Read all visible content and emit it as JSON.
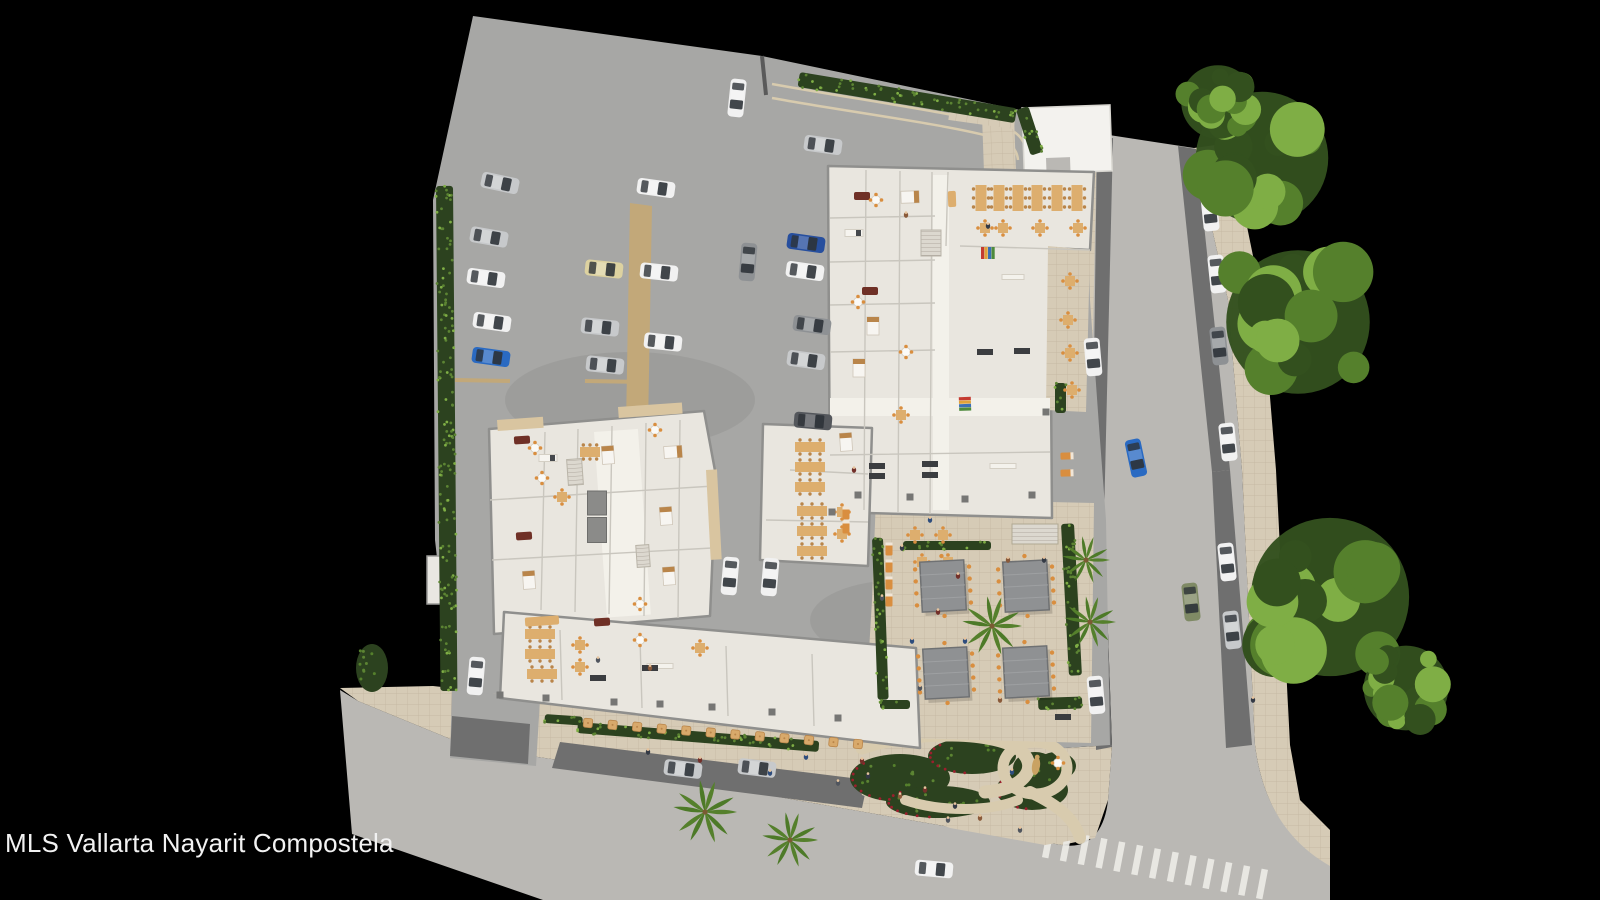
{
  "watermark": "MLS Vallarta Nayarit Compostela",
  "palette": {
    "bg": "#000000",
    "lot": "#a7a7a5",
    "street": "#bab8b4",
    "cobble": "#6f6f6f",
    "sidewalk": "#d6cbb6",
    "grout": "#c2b59e",
    "floor": "#e9e6df",
    "floorLight": "#f3f1ea",
    "partition": "#c9c6be",
    "wall": "#8f8f8d",
    "roofWhite": "#f3f2ee",
    "balcony": "#d9c5a0",
    "walkwayTan": "#c2a879",
    "hedgeDark": "#2c421f",
    "hedgeLeaf": "#5c8433",
    "treeDark": "#33501e",
    "treeMid": "#55802c",
    "treeLight": "#7fae45",
    "palmGreen": "#4d7a28",
    "pergola": "#8f9193",
    "pergolaDark": "#6f7173",
    "umbrella": "#d8a96b",
    "tableTan": "#ddae6e",
    "tableDark": "#b9854a",
    "chairOrange": "#d98e3f",
    "maroon": "#6f3026",
    "counterDark": "#3c3c3c",
    "flowerRed": "#9c1f2d",
    "statueTan": "#c9a263",
    "stairLight": "#dcd8cf",
    "shaft": "#8b8b89",
    "pillar": "#767674",
    "pathBeige": "#d8cbae",
    "stripe": "#eceae6",
    "text": "#f2f2f2",
    "skin": "#e6c49e",
    "carWhite": "#f1f1f1",
    "carSilver": "#c7c9cb",
    "carGray": "#8e9194",
    "carDark": "#54575c",
    "carBlue": "#2a6ac2",
    "carBlueDark": "#274f9e",
    "carBeige": "#ddd2a0",
    "carGreen": "#7f8a65"
  },
  "scene": {
    "cars": [
      {
        "x": 500,
        "y": 183,
        "a": 12,
        "c": "carSilver"
      },
      {
        "x": 489,
        "y": 237,
        "a": 10,
        "c": "carSilver"
      },
      {
        "x": 486,
        "y": 278,
        "a": 8,
        "c": "carWhite"
      },
      {
        "x": 492,
        "y": 322,
        "a": 8,
        "c": "carWhite"
      },
      {
        "x": 491,
        "y": 357,
        "a": 8,
        "c": "carBlue"
      },
      {
        "x": 656,
        "y": 188,
        "a": 8,
        "c": "carWhite"
      },
      {
        "x": 604,
        "y": 269,
        "a": 6,
        "c": "carBeige"
      },
      {
        "x": 659,
        "y": 272,
        "a": 6,
        "c": "carWhite"
      },
      {
        "x": 600,
        "y": 327,
        "a": 6,
        "c": "carSilver"
      },
      {
        "x": 663,
        "y": 342,
        "a": 6,
        "c": "carWhite"
      },
      {
        "x": 605,
        "y": 365,
        "a": 6,
        "c": "carSilver"
      },
      {
        "x": 737,
        "y": 98,
        "a": 96,
        "c": "carWhite"
      },
      {
        "x": 823,
        "y": 145,
        "a": 8,
        "c": "carSilver"
      },
      {
        "x": 748,
        "y": 262,
        "a": 95,
        "c": "carGray"
      },
      {
        "x": 806,
        "y": 243,
        "a": 8,
        "c": "carBlueDark"
      },
      {
        "x": 805,
        "y": 271,
        "a": 8,
        "c": "carWhite"
      },
      {
        "x": 812,
        "y": 325,
        "a": 8,
        "c": "carGray"
      },
      {
        "x": 806,
        "y": 360,
        "a": 8,
        "c": "carSilver"
      },
      {
        "x": 813,
        "y": 421,
        "a": 5,
        "c": "carDark"
      },
      {
        "x": 730,
        "y": 576,
        "a": 95,
        "c": "carWhite"
      },
      {
        "x": 770,
        "y": 577,
        "a": 95,
        "c": "carWhite"
      },
      {
        "x": 476,
        "y": 676,
        "a": 95,
        "c": "carWhite"
      },
      {
        "x": 1210,
        "y": 212,
        "a": 84,
        "c": "carWhite"
      },
      {
        "x": 1217,
        "y": 274,
        "a": 84,
        "c": "carWhite"
      },
      {
        "x": 1219,
        "y": 346,
        "a": 84,
        "c": "carGray"
      },
      {
        "x": 1093,
        "y": 357,
        "a": 85,
        "c": "carWhite"
      },
      {
        "x": 1228,
        "y": 442,
        "a": 84,
        "c": "carWhite"
      },
      {
        "x": 1136,
        "y": 458,
        "a": 78,
        "c": "carBlue"
      },
      {
        "x": 1227,
        "y": 562,
        "a": 84,
        "c": "carWhite"
      },
      {
        "x": 1191,
        "y": 602,
        "a": 84,
        "c": "carGreen"
      },
      {
        "x": 1232,
        "y": 630,
        "a": 84,
        "c": "carSilver"
      },
      {
        "x": 1096,
        "y": 695,
        "a": 85,
        "c": "carWhite"
      },
      {
        "x": 683,
        "y": 769,
        "a": 7,
        "c": "carSilver"
      },
      {
        "x": 757,
        "y": 768,
        "a": 7,
        "c": "carSilver"
      },
      {
        "x": 934,
        "y": 869,
        "a": 5,
        "c": "carWhite"
      }
    ],
    "trees": [
      {
        "x": 1262,
        "y": 158,
        "r": 72
      },
      {
        "x": 1218,
        "y": 102,
        "r": 40
      },
      {
        "x": 1298,
        "y": 322,
        "r": 78
      },
      {
        "x": 1330,
        "y": 597,
        "r": 86
      },
      {
        "x": 1406,
        "y": 688,
        "r": 46
      }
    ],
    "palms": [
      {
        "x": 705,
        "y": 812,
        "r": 32
      },
      {
        "x": 790,
        "y": 840,
        "r": 28
      },
      {
        "x": 1086,
        "y": 560,
        "r": 24
      },
      {
        "x": 1090,
        "y": 622,
        "r": 26
      },
      {
        "x": 992,
        "y": 626,
        "r": 30
      }
    ],
    "pergolas": [
      {
        "x": 943,
        "y": 586
      },
      {
        "x": 1026,
        "y": 586
      },
      {
        "x": 946,
        "y": 673
      },
      {
        "x": 1026,
        "y": 672
      }
    ],
    "people": {
      "colors": [
        "#343a45",
        "#73302a",
        "#2e4d7d",
        "#50555e",
        "#8a5a3a"
      ],
      "items": [
        {
          "x": 902,
          "y": 548
        },
        {
          "x": 938,
          "y": 612
        },
        {
          "x": 965,
          "y": 641
        },
        {
          "x": 920,
          "y": 688
        },
        {
          "x": 1000,
          "y": 700
        },
        {
          "x": 1044,
          "y": 560
        },
        {
          "x": 958,
          "y": 576
        },
        {
          "x": 912,
          "y": 641
        },
        {
          "x": 882,
          "y": 598
        },
        {
          "x": 1008,
          "y": 560
        },
        {
          "x": 648,
          "y": 752
        },
        {
          "x": 700,
          "y": 760
        },
        {
          "x": 770,
          "y": 773
        },
        {
          "x": 838,
          "y": 783
        },
        {
          "x": 900,
          "y": 796
        },
        {
          "x": 955,
          "y": 806
        },
        {
          "x": 862,
          "y": 761
        },
        {
          "x": 806,
          "y": 757
        },
        {
          "x": 1020,
          "y": 830
        },
        {
          "x": 980,
          "y": 818
        },
        {
          "x": 868,
          "y": 776
        },
        {
          "x": 925,
          "y": 790
        },
        {
          "x": 1012,
          "y": 772
        },
        {
          "x": 948,
          "y": 820
        },
        {
          "x": 906,
          "y": 215
        },
        {
          "x": 988,
          "y": 226
        },
        {
          "x": 854,
          "y": 470
        },
        {
          "x": 930,
          "y": 520
        },
        {
          "x": 598,
          "y": 660
        },
        {
          "x": 650,
          "y": 668
        },
        {
          "x": 1253,
          "y": 700
        }
      ]
    },
    "umbrella_row": {
      "x1": 588,
      "y1": 723,
      "x2": 858,
      "y2": 744,
      "count": 12
    },
    "crosswalk": {
      "x1": 1048,
      "y1": 843,
      "x2": 1262,
      "y2": 884,
      "count": 13,
      "len": 30,
      "w": 6.5
    },
    "hedges": [
      {
        "x": 436,
        "y": 186,
        "w": 17,
        "h": 505,
        "a": -0.5
      },
      {
        "x": 800,
        "y": 72,
        "w": 220,
        "h": 15,
        "a": 9.5
      },
      {
        "x": 1016,
        "y": 110,
        "w": 13,
        "h": 48,
        "a": -18
      },
      {
        "x": 578,
        "y": 722,
        "w": 242,
        "h": 11,
        "a": 4.5
      },
      {
        "x": 545,
        "y": 714,
        "w": 38,
        "h": 9,
        "a": 4
      },
      {
        "x": 872,
        "y": 538,
        "w": 11,
        "h": 162,
        "a": -2
      },
      {
        "x": 1061,
        "y": 524,
        "w": 13,
        "h": 152,
        "a": -3
      },
      {
        "x": 903,
        "y": 541,
        "w": 88,
        "h": 9,
        "a": 0
      },
      {
        "x": 1038,
        "y": 698,
        "w": 44,
        "h": 12,
        "a": -2
      },
      {
        "x": 1055,
        "y": 383,
        "w": 11,
        "h": 30,
        "a": 0
      },
      {
        "x": 880,
        "y": 700,
        "w": 30,
        "h": 9,
        "a": 0
      }
    ],
    "garden_beds": [
      {
        "x": 372,
        "y": 668,
        "rx": 16,
        "ry": 24,
        "f": 0
      },
      {
        "x": 900,
        "y": 778,
        "rx": 50,
        "ry": 24,
        "f": 1
      },
      {
        "x": 972,
        "y": 756,
        "rx": 44,
        "ry": 18,
        "f": 1
      },
      {
        "x": 1032,
        "y": 790,
        "rx": 36,
        "ry": 20,
        "f": 1
      },
      {
        "x": 938,
        "y": 802,
        "rx": 52,
        "ry": 16,
        "f": 1
      },
      {
        "x": 1056,
        "y": 766,
        "rx": 20,
        "ry": 14,
        "f": 0
      },
      {
        "x": 1035,
        "y": 768,
        "rx": 22,
        "ry": 16,
        "f": 0
      }
    ],
    "furniture": [
      {
        "t": "table_long_v",
        "x": 981,
        "y": 198
      },
      {
        "t": "table_long_v",
        "x": 999,
        "y": 198
      },
      {
        "t": "table_long_v",
        "x": 1018,
        "y": 198
      },
      {
        "t": "table_long_v",
        "x": 1037,
        "y": 198
      },
      {
        "t": "table_long_v",
        "x": 1057,
        "y": 198
      },
      {
        "t": "table_long_v",
        "x": 1077,
        "y": 198
      },
      {
        "t": "table_sq",
        "x": 985,
        "y": 228
      },
      {
        "t": "table_sq",
        "x": 1003,
        "y": 228
      },
      {
        "t": "table_sq",
        "x": 1040,
        "y": 228
      },
      {
        "t": "table_sq",
        "x": 1078,
        "y": 228
      },
      {
        "t": "table_sq",
        "x": 1070,
        "y": 281
      },
      {
        "t": "table_sq",
        "x": 1068,
        "y": 320
      },
      {
        "t": "table_sq",
        "x": 1070,
        "y": 353
      },
      {
        "t": "table_sq",
        "x": 1072,
        "y": 390
      },
      {
        "t": "table_long_h",
        "x": 810,
        "y": 447
      },
      {
        "t": "table_long_h",
        "x": 810,
        "y": 467
      },
      {
        "t": "table_long_h",
        "x": 810,
        "y": 487
      },
      {
        "t": "table_long_h",
        "x": 812,
        "y": 511
      },
      {
        "t": "table_long_h",
        "x": 812,
        "y": 531
      },
      {
        "t": "table_long_h",
        "x": 812,
        "y": 551
      },
      {
        "t": "table_sq",
        "x": 842,
        "y": 512
      },
      {
        "t": "table_sq",
        "x": 842,
        "y": 534
      },
      {
        "t": "table_sq",
        "x": 915,
        "y": 535
      },
      {
        "t": "table_sq",
        "x": 943,
        "y": 535
      },
      {
        "t": "table_sq",
        "x": 922,
        "y": 562
      },
      {
        "t": "table_sq",
        "x": 948,
        "y": 562
      },
      {
        "t": "table_long_h",
        "x": 540,
        "y": 634
      },
      {
        "t": "table_long_h",
        "x": 540,
        "y": 654
      },
      {
        "t": "table_long_h",
        "x": 542,
        "y": 674
      },
      {
        "t": "table_sq",
        "x": 580,
        "y": 645
      },
      {
        "t": "table_sq",
        "x": 580,
        "y": 667
      },
      {
        "t": "table_round",
        "x": 640,
        "y": 640
      },
      {
        "t": "table_sq",
        "x": 700,
        "y": 648
      },
      {
        "t": "counter",
        "x": 660,
        "y": 666,
        "w": 26
      },
      {
        "t": "shelf_dark",
        "x": 598,
        "y": 678
      },
      {
        "t": "shelf_dark",
        "x": 650,
        "y": 668
      },
      {
        "t": "sofa",
        "x": 522,
        "y": 440,
        "a": -4
      },
      {
        "t": "table_round",
        "x": 535,
        "y": 448
      },
      {
        "t": "bed",
        "x": 608,
        "y": 455,
        "a": -4
      },
      {
        "t": "bed",
        "x": 673,
        "y": 452,
        "a": 86
      },
      {
        "t": "table_round",
        "x": 655,
        "y": 430
      },
      {
        "t": "sofa",
        "x": 524,
        "y": 536,
        "a": -4
      },
      {
        "t": "table_round",
        "x": 542,
        "y": 478
      },
      {
        "t": "table_sq",
        "x": 562,
        "y": 497
      },
      {
        "t": "bed",
        "x": 529,
        "y": 580,
        "a": -4
      },
      {
        "t": "bed",
        "x": 666,
        "y": 516,
        "a": -4
      },
      {
        "t": "bed",
        "x": 669,
        "y": 576,
        "a": -4
      },
      {
        "t": "kitchen",
        "x": 548,
        "y": 458
      },
      {
        "t": "table_long_h",
        "x": 590,
        "y": 452,
        "w": 20
      },
      {
        "t": "table_round",
        "x": 640,
        "y": 604
      },
      {
        "t": "sofa",
        "x": 602,
        "y": 622,
        "a": -4
      },
      {
        "t": "stairs",
        "x": 575,
        "y": 472,
        "w": 15,
        "h": 26,
        "a": -4
      },
      {
        "t": "shaft",
        "x": 597,
        "y": 503,
        "w": 19,
        "h": 24
      },
      {
        "t": "shaft",
        "x": 597,
        "y": 530,
        "w": 19,
        "h": 25
      },
      {
        "t": "stairs",
        "x": 643,
        "y": 556,
        "w": 13,
        "h": 22,
        "a": -4
      },
      {
        "t": "sofa",
        "x": 862,
        "y": 196
      },
      {
        "t": "table_round",
        "x": 876,
        "y": 200
      },
      {
        "t": "bed",
        "x": 910,
        "y": 197,
        "a": 88
      },
      {
        "t": "kitchen",
        "x": 854,
        "y": 233
      },
      {
        "t": "sofa",
        "x": 870,
        "y": 291
      },
      {
        "t": "table_round",
        "x": 858,
        "y": 302
      },
      {
        "t": "bed",
        "x": 873,
        "y": 326
      },
      {
        "t": "bed",
        "x": 859,
        "y": 368
      },
      {
        "t": "table_round",
        "x": 906,
        "y": 352
      },
      {
        "t": "table_sq",
        "x": 901,
        "y": 415
      },
      {
        "t": "bed",
        "x": 846,
        "y": 442,
        "a": -4
      },
      {
        "t": "sofa",
        "x": 952,
        "y": 199,
        "a": 88,
        "c": "tan"
      },
      {
        "t": "shelf_color",
        "x": 988,
        "y": 253
      },
      {
        "t": "shelf_color",
        "x": 965,
        "y": 404,
        "a": 88
      },
      {
        "t": "counter",
        "x": 1013,
        "y": 277,
        "w": 22
      },
      {
        "t": "shelf_dark",
        "x": 1022,
        "y": 351
      },
      {
        "t": "shelf_dark",
        "x": 985,
        "y": 352
      },
      {
        "t": "stairs",
        "x": 931,
        "y": 243,
        "w": 20,
        "h": 26
      },
      {
        "t": "shelf_dark",
        "x": 930,
        "y": 464
      },
      {
        "t": "shelf_dark",
        "x": 930,
        "y": 475
      },
      {
        "t": "shelf_dark",
        "x": 877,
        "y": 466
      },
      {
        "t": "shelf_dark",
        "x": 877,
        "y": 476
      },
      {
        "t": "counter",
        "x": 1003,
        "y": 466,
        "w": 26
      },
      {
        "t": "lounger",
        "x": 889,
        "y": 549
      },
      {
        "t": "lounger",
        "x": 889,
        "y": 566
      },
      {
        "t": "lounger",
        "x": 889,
        "y": 583
      },
      {
        "t": "lounger",
        "x": 889,
        "y": 600
      },
      {
        "t": "lounger",
        "x": 846,
        "y": 513
      },
      {
        "t": "lounger",
        "x": 846,
        "y": 527
      },
      {
        "t": "lounger",
        "x": 1067,
        "y": 456,
        "a": 88
      },
      {
        "t": "lounger",
        "x": 1067,
        "y": 473,
        "a": 88
      },
      {
        "t": "statue",
        "x": 1036,
        "y": 766,
        "a": 8
      },
      {
        "t": "table_round",
        "x": 1058,
        "y": 763
      },
      {
        "t": "shelf_dark",
        "x": 1063,
        "y": 717
      },
      {
        "t": "awning",
        "x": 542,
        "y": 621,
        "w": 34,
        "h": 9,
        "a": -4
      },
      {
        "t": "pillar",
        "x": 500,
        "y": 695
      },
      {
        "t": "pillar",
        "x": 546,
        "y": 698
      },
      {
        "t": "pillar",
        "x": 614,
        "y": 702
      },
      {
        "t": "pillar",
        "x": 660,
        "y": 704
      },
      {
        "t": "pillar",
        "x": 712,
        "y": 707
      },
      {
        "t": "pillar",
        "x": 772,
        "y": 712
      },
      {
        "t": "pillar",
        "x": 838,
        "y": 718
      },
      {
        "t": "pillar",
        "x": 858,
        "y": 495
      },
      {
        "t": "pillar",
        "x": 910,
        "y": 497
      },
      {
        "t": "pillar",
        "x": 965,
        "y": 499
      },
      {
        "t": "pillar",
        "x": 1032,
        "y": 495
      },
      {
        "t": "pillar",
        "x": 832,
        "y": 512
      },
      {
        "t": "pillar",
        "x": 1046,
        "y": 412
      }
    ]
  }
}
